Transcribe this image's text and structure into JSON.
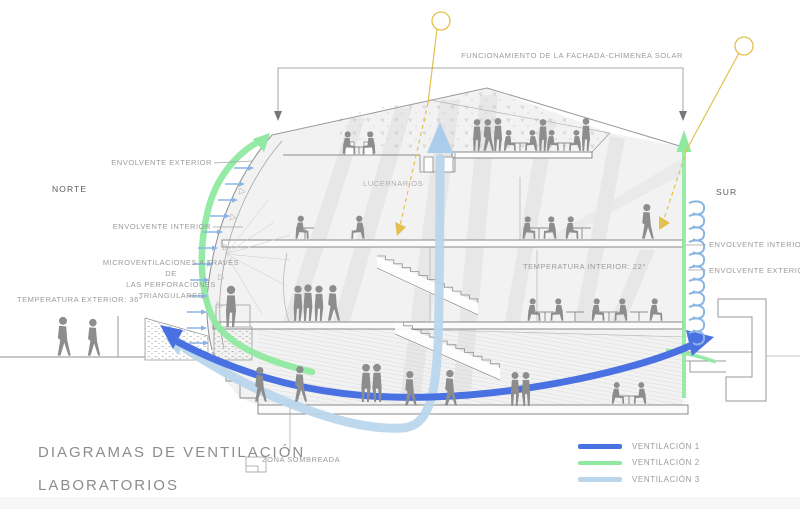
{
  "title": {
    "line1": "DIAGRAMAS DE VENTILACIÓN",
    "line2": "LABORATORIOS"
  },
  "compass": {
    "north": "NORTE",
    "south": "SUR"
  },
  "annotations": {
    "solar_chimney": "FUNCIONAMIENTO DE LA FACHADA-CHIMENEA SOLAR",
    "envolvente_exterior_left": "ENVOLVENTE EXTERIOR",
    "envolvente_interior_left": "ENVOLVENTE INTERIOR",
    "microventilaciones_line1": "MICROVENTILACIONES A TRAVÉS DE",
    "microventilaciones_line2": "LAS PERFORACIONES TRIANGULARES",
    "temperatura_exterior": "TEMPERATURA EXTERIOR: 36°",
    "lucernarios": "LUCERNARIOS",
    "temperatura_interior": "TEMPERATURA INTERIOR: 22°",
    "envolvente_interior_right": "ENVOLVENTE INTERIOR",
    "envolvente_exterior_right": "ENVOLVENTE EXTERIOR",
    "zona_sombreada": "ZONA SOMBREADA"
  },
  "legend": {
    "items": [
      {
        "label": "VENTILACIÓN 1",
        "color": "#4a71e2"
      },
      {
        "label": "VENTILACIÓN 2",
        "color": "#8fe9a0"
      },
      {
        "label": "VENTILACIÓN 3",
        "color": "#b9d6ec"
      }
    ]
  },
  "colors": {
    "ventilacion1_blue": "#4a71e2",
    "ventilacion2_green": "#8fe9a0",
    "ventilacion3_lightblue": "#b9d6ec",
    "sun_yellow": "#e2c14f",
    "silhouette_gray": "#8d8d8d",
    "line_gray": "#9a9a9a"
  }
}
